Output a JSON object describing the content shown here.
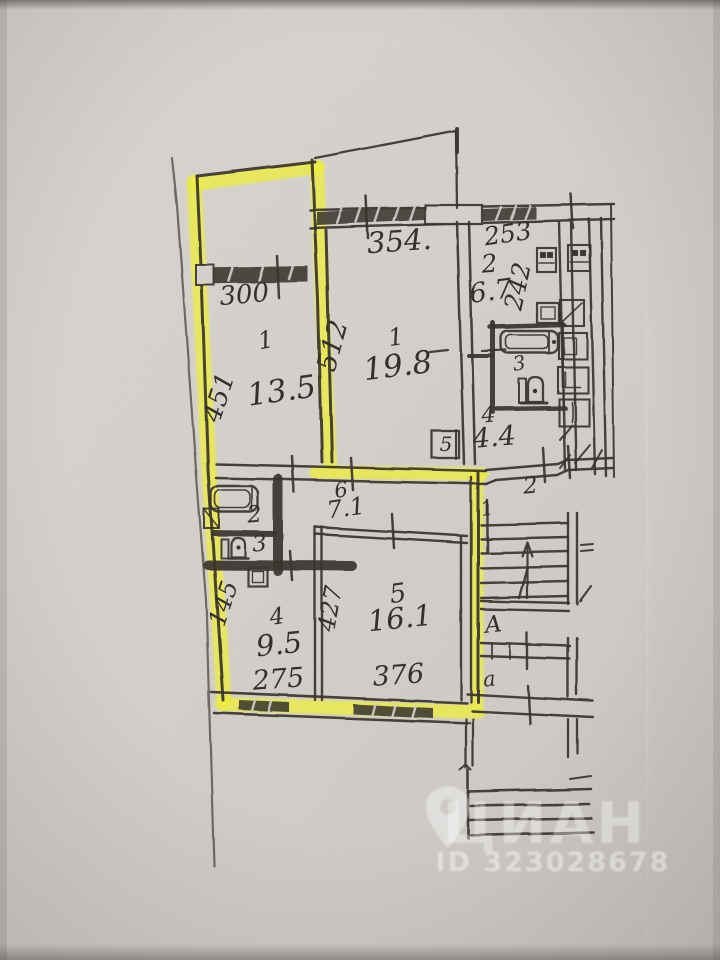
{
  "colors": {
    "paper": "#d4d1cd",
    "ink": "#37322c",
    "pencil": "#554e46",
    "highlight": "#eff03c",
    "watermark": "#ffffff"
  },
  "watermark": {
    "logo_icon": "map-pin-icon",
    "logo": "ЦИАН",
    "id_label": "ID 323028678"
  },
  "labels": {
    "upper_room_width": "300",
    "upper_room_height": "451",
    "upper_room_no": "1",
    "upper_room_area": "13.5",
    "mid_room_width": "354.",
    "mid_room_height": "512",
    "mid_room_no": "1",
    "mid_room_area": "19.8",
    "kitchen_right_width": "253",
    "kitchen_right_no": "2",
    "kitchen_right_area": "6.7",
    "kitchen_right_height": "242",
    "bathroom_right_no": "3",
    "hall_right_no": "4",
    "hall_right_area": "4.4",
    "closet_no": "5",
    "corridor_no": "2",
    "corridor_door_no": "1",
    "hall_lower_no": "6",
    "hall_lower_area": "7.1",
    "bath_lower_no": "2",
    "wc_lower_no": "3",
    "kitchen_lower_height": "145",
    "kitchen_lower_no": "4",
    "kitchen_lower_area": "9.5",
    "room_lower_no": "5",
    "room_lower_area": "16.1",
    "room_lower_height": "427",
    "room_lower_width": "376",
    "kitchen_lower_width": "275",
    "stair_upper": "А",
    "stair_lower": "а"
  }
}
